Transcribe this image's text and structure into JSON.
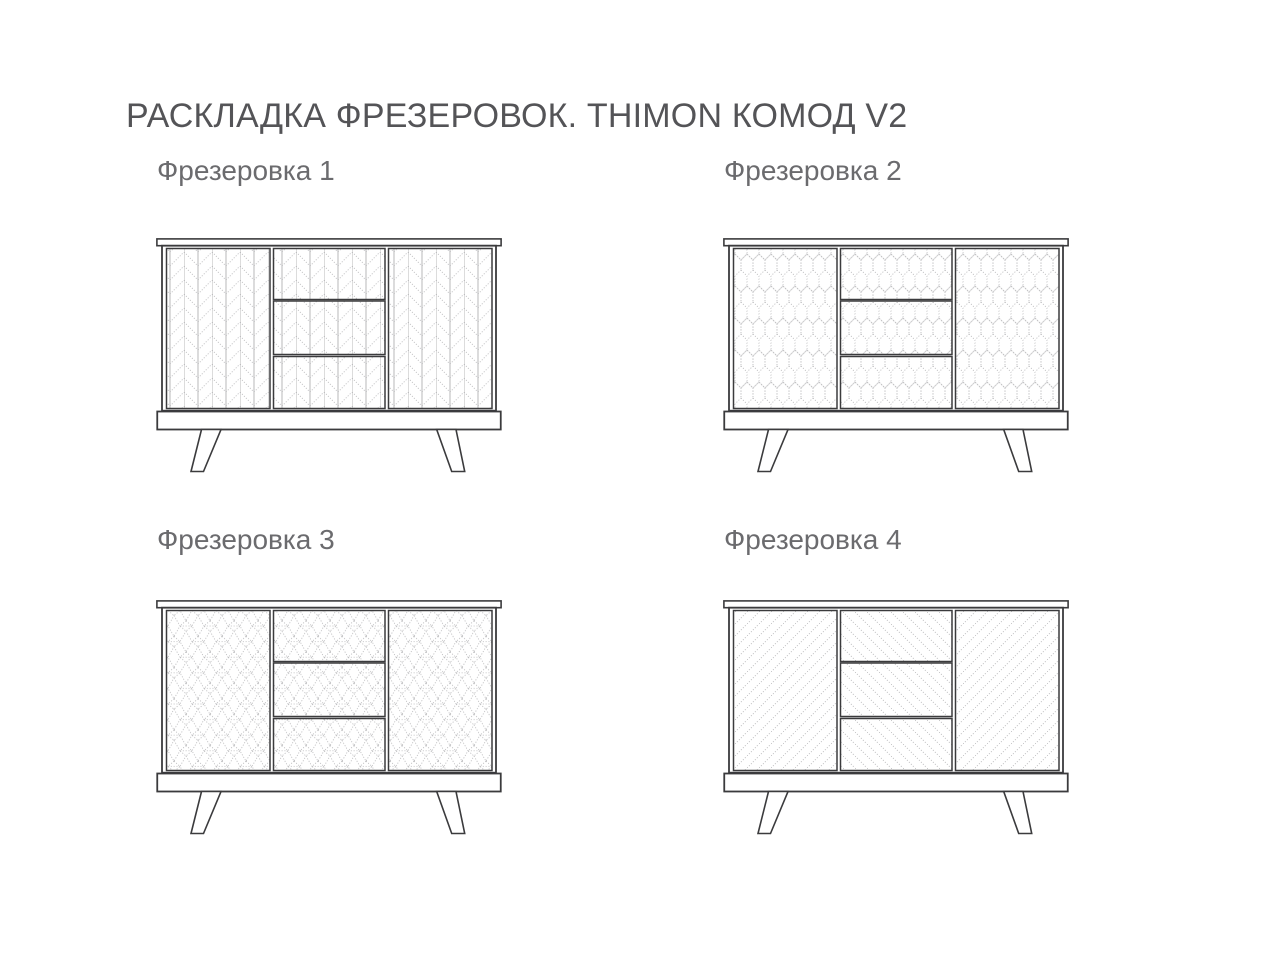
{
  "page_title": "РАСКЛАДКА ФРЕЗЕРОВОК. THIMON КОМОД V2",
  "variants": [
    {
      "label": "Фрезеровка 1",
      "doors_pattern": "herringbone",
      "drawers_pattern": "herringbone"
    },
    {
      "label": "Фрезеровка 2",
      "doors_pattern": "hexagon",
      "drawers_pattern": "hexagon"
    },
    {
      "label": "Фрезеровка 3",
      "doors_pattern": "cubes",
      "drawers_pattern": "cubes"
    },
    {
      "label": "Фрезеровка 4",
      "doors_pattern": "diagonal-up",
      "drawers_pattern": "diagonal-down"
    }
  ],
  "colors": {
    "title": "#545457",
    "label": "#6b6b6e",
    "outline": "#3b3b3d",
    "pattern_line": "#b9b9bb",
    "pattern_grid": "#a6a6a8",
    "background": "#ffffff"
  }
}
